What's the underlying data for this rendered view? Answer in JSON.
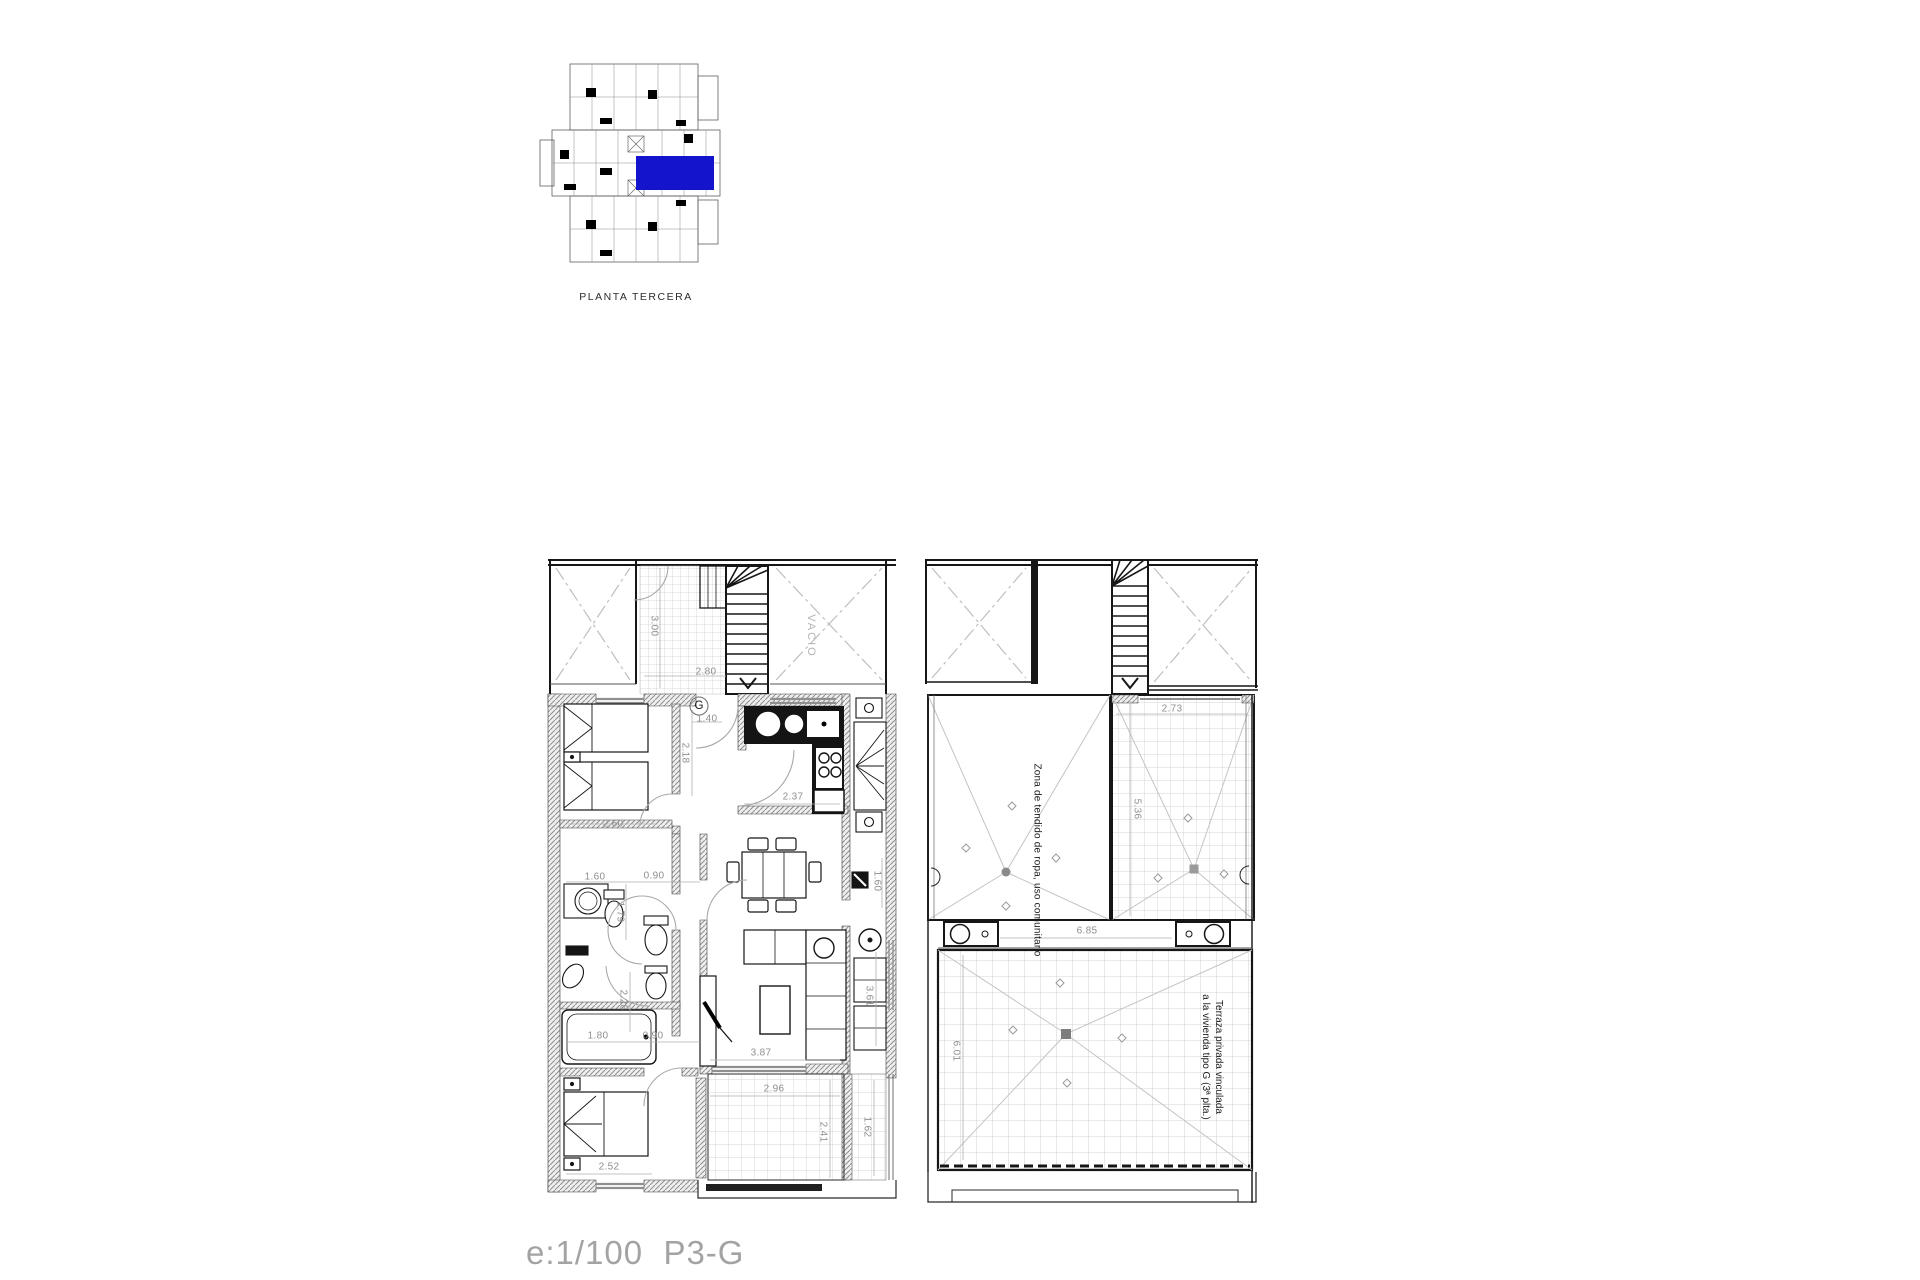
{
  "key_plan": {
    "label": "PLANTA TERCERA",
    "highlight_color": "#1414cc"
  },
  "scale_label": "e:1/100  P3-G",
  "unit_label": "G",
  "labels": {
    "vacio": "VACIO",
    "zona_tendido": "Zona de tendido de ropa, uso comunitario",
    "terraza_1": "Terraza privada vinculada",
    "terraza_2": "a la vivienda tipo G (3ª plta.)"
  },
  "dims": {
    "d300": "3.00",
    "d280": "2.80",
    "d260": "2.60",
    "d218": "2.18",
    "d140": "1.40",
    "d237": "2.37",
    "d160": "1.60",
    "d090": "0.90",
    "d179": "1.79",
    "d228": "2.28",
    "d180": "1.80",
    "d387": "3.87",
    "d252": "2.52",
    "d296": "2.96",
    "d241": "2.41",
    "d162": "1.62",
    "d361": "3.61",
    "d273": "2.73",
    "d536": "5.36",
    "d685": "6.85",
    "d601": "6.01"
  }
}
